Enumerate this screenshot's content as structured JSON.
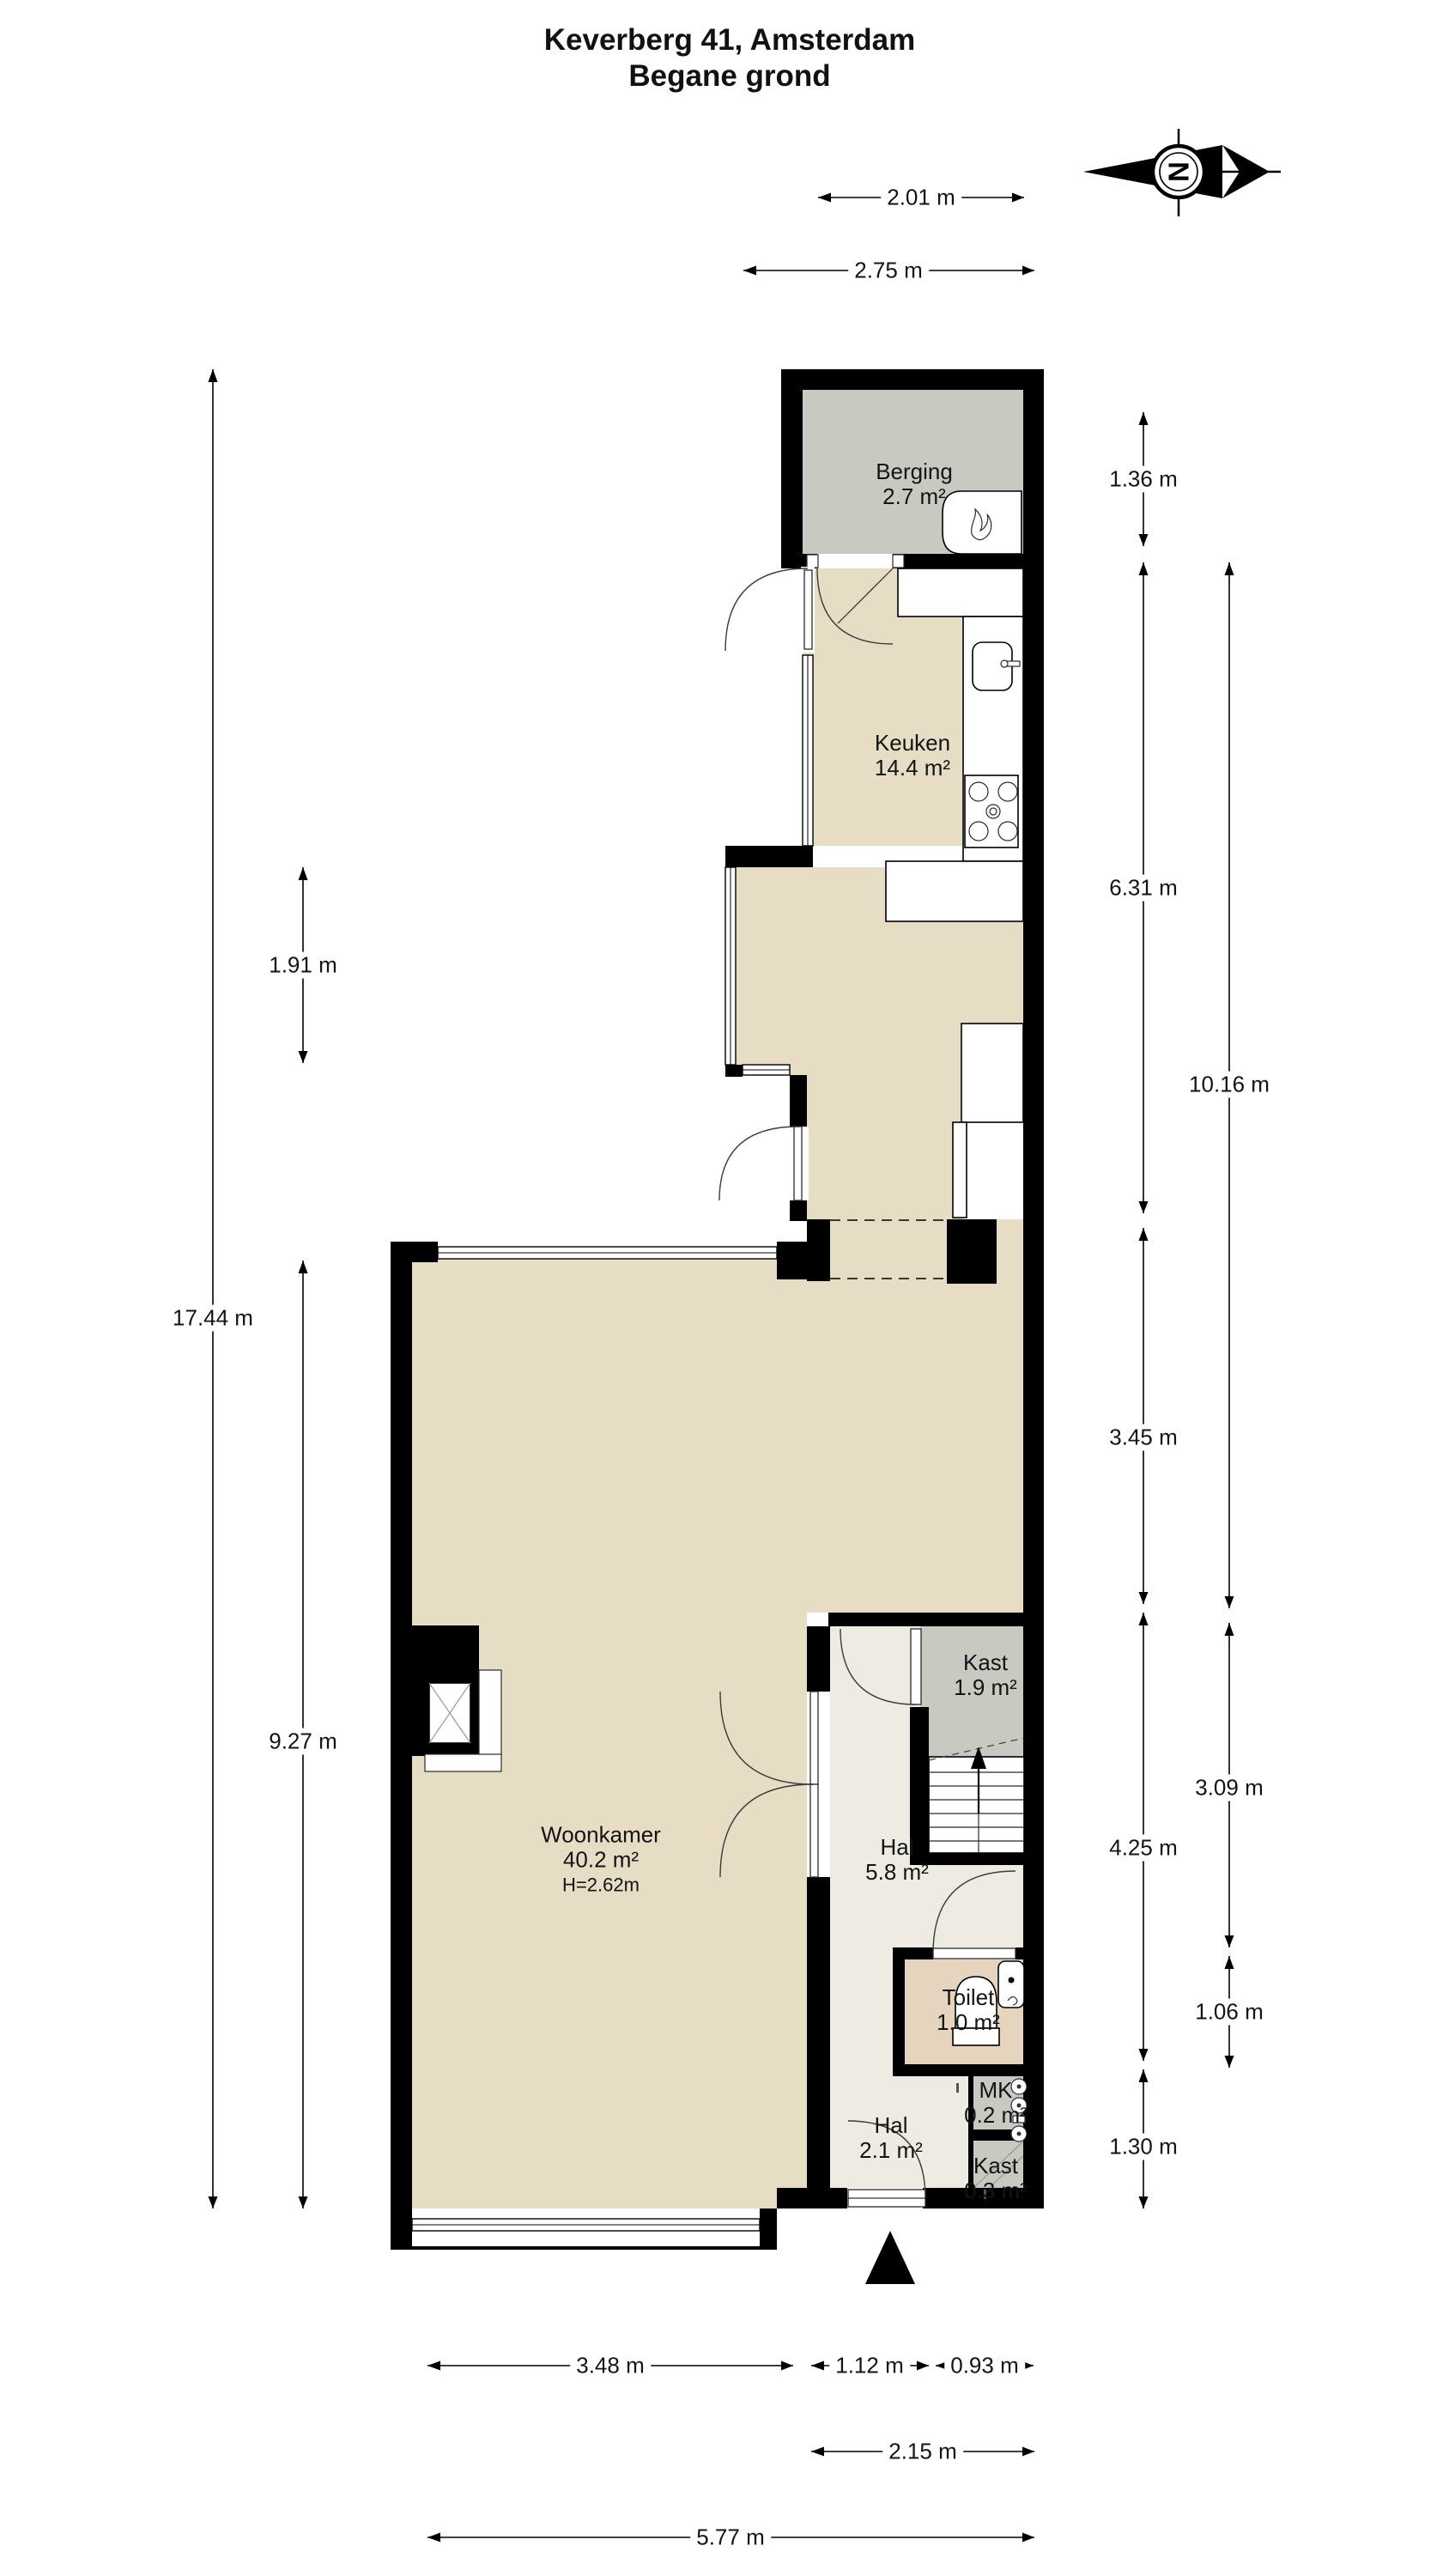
{
  "title": {
    "line1": "Keverberg 41, Amsterdam",
    "line2": "Begane grond"
  },
  "compass": {
    "letter": "N",
    "direction": "north-pointing-left"
  },
  "rooms": {
    "berging": {
      "name": "Berging",
      "area": "2.7 m²",
      "floor": "gray"
    },
    "keuken": {
      "name": "Keuken",
      "area": "14.4 m²",
      "floor": "beige"
    },
    "woonkamer": {
      "name": "Woonkamer",
      "area": "40.2 m²",
      "height": "H=2.62m",
      "floor": "beige"
    },
    "kast": {
      "name": "Kast",
      "area": "1.9 m²",
      "floor": "gray"
    },
    "hal": {
      "name": "Hal",
      "area": "5.8 m²",
      "floor": "light"
    },
    "toilet": {
      "name": "Toilet",
      "area": "1.0 m²",
      "floor": "toilet-beige"
    },
    "mk": {
      "name": "MK",
      "area": "0.2 m²",
      "floor": "gray"
    },
    "hal2": {
      "name": "Hal",
      "area": "2.1 m²",
      "floor": "light"
    },
    "kast2": {
      "name": "Kast",
      "area": "0.3 m²",
      "floor": "gray"
    }
  },
  "dims": {
    "top_inner": "2.01 m",
    "top_outer": "2.75 m",
    "left_total": "17.44 m",
    "left_window": "1.91 m",
    "left_living": "9.27 m",
    "right_berging": "1.36 m",
    "right_kitchen": "6.31 m",
    "right_kitchen_total": "10.16 m",
    "right_living_top": "3.45 m",
    "right_hall": "3.09 m",
    "right_living_bottom": "4.25 m",
    "right_toilet": "1.06 m",
    "right_entrance": "1.30 m",
    "bottom_living": "3.48 m",
    "bottom_hall": "1.12 m",
    "bottom_closet": "0.93 m",
    "bottom_hall_total": "2.15 m",
    "bottom_total": "5.77 m"
  },
  "colors": {
    "wall": "#000000",
    "floor_beige": "#e7dcc4",
    "floor_gray": "#c8c9c1",
    "floor_light": "#eeebe3",
    "floor_toilet": "#e5d5bf",
    "accent_text": "#141414"
  }
}
